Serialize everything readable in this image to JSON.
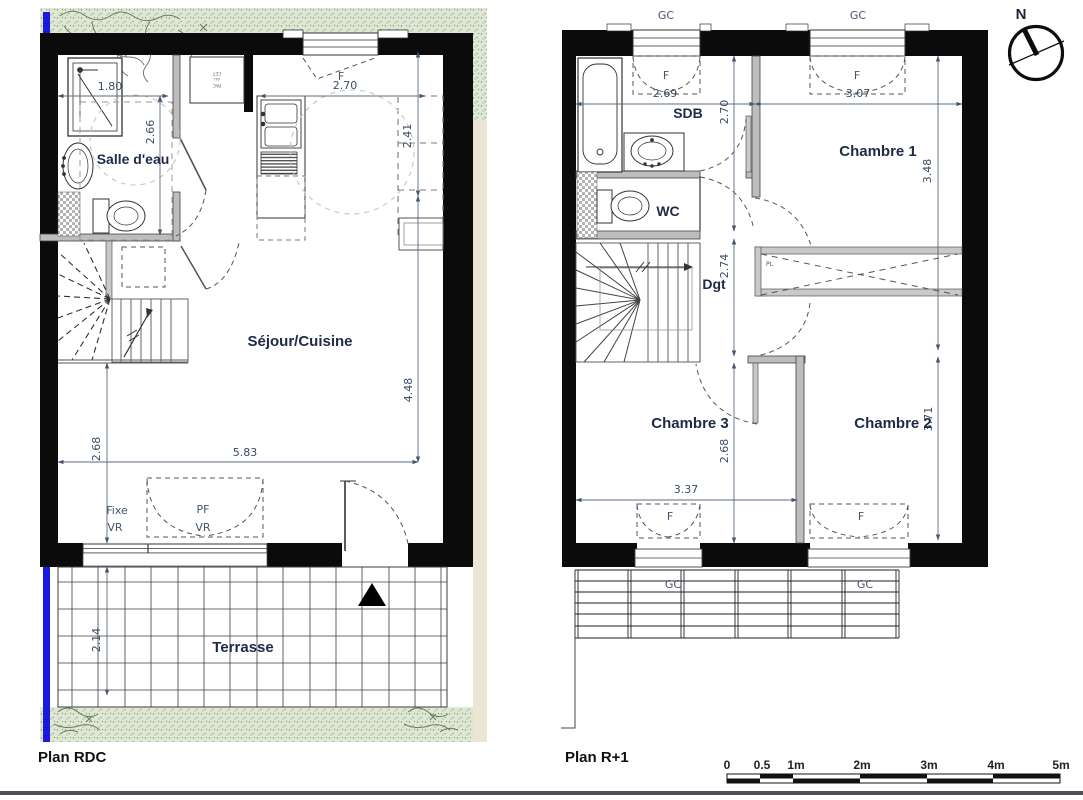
{
  "compass": {
    "north": "N"
  },
  "rdc": {
    "title": "Plan RDC",
    "rooms": {
      "salle_deau": "Salle d'eau",
      "sejour_cuisine": "Séjour/Cuisine",
      "terrasse": "Terrasse"
    },
    "dims": {
      "salle_deau_width": "1.80",
      "salle_deau_depth": "2.66",
      "cuisine_width": "2.70",
      "placard_depth": "2.41",
      "sejour_depth": "4.48",
      "sejour_width": "5.83",
      "entree_depth": "2.68",
      "terrasse_depth": "2.14"
    },
    "openings": {
      "fenetre": "F",
      "baie_fixe": "Fixe",
      "baie_fixe_volet": "VR",
      "baie_pf": "PF",
      "baie_pf_volet": "VR"
    },
    "tech_closet": {
      "line1": "PAC",
      "line2": "ou",
      "line3": "CET"
    }
  },
  "r1": {
    "title": "Plan R+1",
    "rooms": {
      "sdb": "SDB",
      "wc": "WC",
      "dgt": "Dgt",
      "chambre1": "Chambre 1",
      "chambre2": "Chambre 2",
      "chambre3": "Chambre 3"
    },
    "dims": {
      "sdb_width": "2.69",
      "chambre1_width": "3.07",
      "sdb_depth": "2.70",
      "chambre1_depth": "3.48",
      "dgt_depth": "2.74",
      "chambre2_depth": "3.71",
      "chambre3_depth": "2.68",
      "chambre3_width": "3.37"
    },
    "openings": {
      "gc_top_left": "GC",
      "gc_top_right": "GC",
      "f_top_left": "F",
      "f_top_right": "F",
      "f_bottom_left": "F",
      "f_bottom_right": "F",
      "gc_bottom_left": "GC",
      "gc_bottom_right": "GC",
      "placard": "PL"
    }
  },
  "scalebar": {
    "labels": [
      "0",
      "0.5",
      "1m",
      "2m",
      "3m",
      "4m",
      "5m"
    ]
  }
}
